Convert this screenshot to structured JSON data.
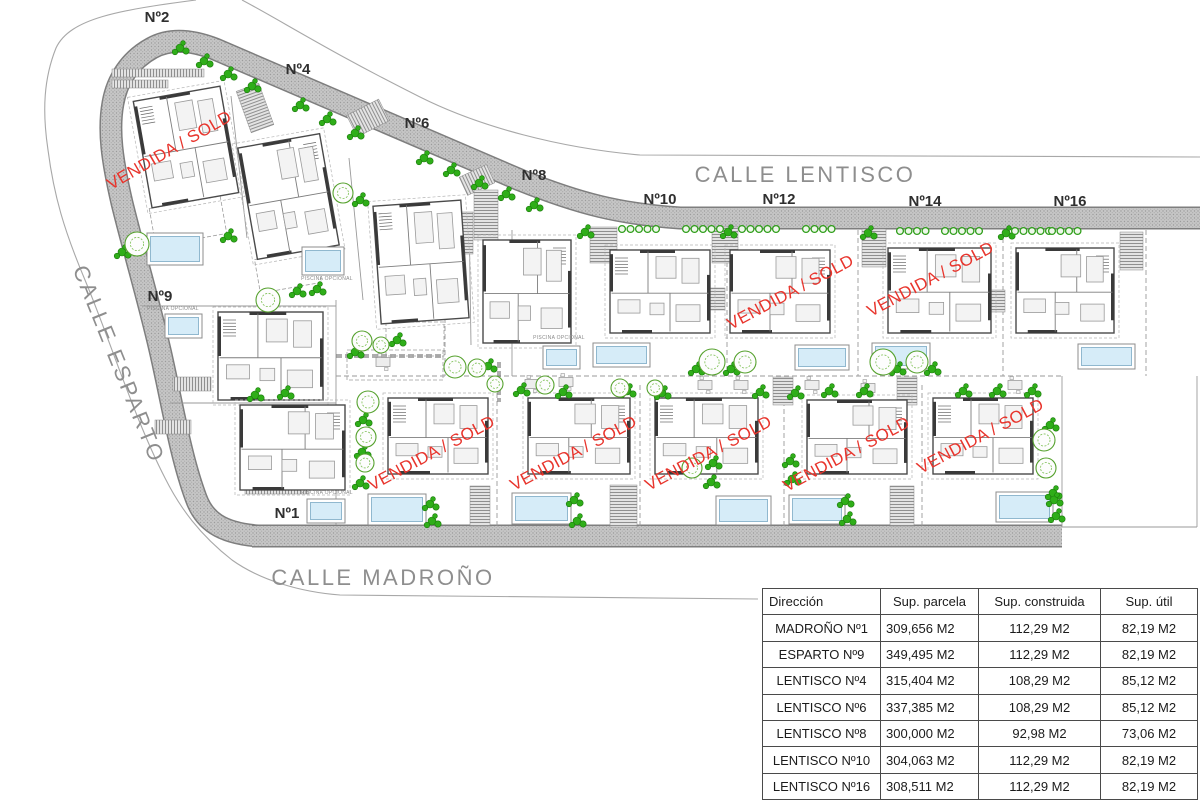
{
  "colors": {
    "road": "#c6c6c6",
    "road_edge": "#7e7e7e",
    "boundary": "#a8a8a8",
    "sold_red": "#e8342c",
    "street_text": "#8e8e8e",
    "lot_text": "#2f2f2f",
    "pool_water": "#d6ecf8",
    "pool_edge": "#90b8cf",
    "pool_frame": "#8c8c8c",
    "green": "#2fae19",
    "green_dark": "#1d7a0e",
    "tree_stroke": "#56a22e",
    "wall": "#4a4a4a",
    "line": "#9a9a9a"
  },
  "plan": {
    "streets": [
      {
        "id": "calle-lentisco",
        "label": "CALLE LENTISCO",
        "x": 805,
        "y": 182,
        "rot": 0
      },
      {
        "id": "calle-madrono",
        "label": "CALLE MADROÑO",
        "x": 383,
        "y": 585,
        "rot": 0
      },
      {
        "id": "calle-esparto",
        "label": "CALLE ESPARTO",
        "x": 112,
        "y": 367,
        "rot": 68
      }
    ],
    "lot_labels": [
      {
        "id": "lot-n2",
        "text": "Nº2",
        "x": 157,
        "y": 22
      },
      {
        "id": "lot-n4",
        "text": "Nº4",
        "x": 298,
        "y": 74
      },
      {
        "id": "lot-n6",
        "text": "Nº6",
        "x": 417,
        "y": 128
      },
      {
        "id": "lot-n8",
        "text": "Nº8",
        "x": 534,
        "y": 180
      },
      {
        "id": "lot-n10",
        "text": "Nº10",
        "x": 660,
        "y": 204
      },
      {
        "id": "lot-n12",
        "text": "Nº12",
        "x": 779,
        "y": 204
      },
      {
        "id": "lot-n14",
        "text": "Nº14",
        "x": 925,
        "y": 206
      },
      {
        "id": "lot-n16",
        "text": "Nº16",
        "x": 1070,
        "y": 206
      },
      {
        "id": "lot-n9",
        "text": "Nº9",
        "x": 160,
        "y": 301
      },
      {
        "id": "lot-n1",
        "text": "Nº1",
        "x": 287,
        "y": 518
      }
    ],
    "sold_label": "VENDIDA / SOLD",
    "sold_marks": [
      [
        172,
        155,
        -30
      ],
      [
        793,
        297,
        -28
      ],
      [
        933,
        284,
        -28
      ],
      [
        434,
        458,
        -28
      ],
      [
        576,
        458,
        -28
      ],
      [
        711,
        458,
        -28
      ],
      [
        849,
        459,
        -28
      ],
      [
        983,
        441,
        -28
      ]
    ],
    "pool_note": "PISCINA OPCIONAL",
    "pool_notes": [
      [
        173,
        310
      ],
      [
        327,
        280
      ],
      [
        327,
        494
      ],
      [
        559,
        339
      ]
    ],
    "roads": {
      "loop": "M 258,536 C 220,533 204,520 196,498 C 180,455 172,402 160,350 C 148,298 133,248 122,203 C 112,160 108,130 113,103 C 117,80 130,60 152,48 C 170,38 192,40 215,49 L 520,180 C 580,204 620,214 680,218 L 1200,218",
      "bottom": "M 252,536 L 1062,536",
      "width": 20
    },
    "boundaries": [
      "M 196,0 C 120,10 70,18 56,48 C 44,78 42,110 48,150 C 54,196 64,230 85,280 C 110,340 135,420 165,478 C 180,508 200,535 232,560 C 260,580 300,592 340,595 L 758,599",
      "M 242,0 C 280,20 330,52 420,97 C 480,127 560,148 640,155 L 1200,157"
    ],
    "plot_lines": [
      [
        512,
        230,
        512,
        376
      ],
      [
        1062,
        376,
        1062,
        527
      ],
      [
        1062,
        527,
        1197,
        527
      ],
      [
        1197,
        376,
        1197,
        527
      ],
      [
        231,
        96,
        247,
        238
      ],
      [
        349,
        158,
        363,
        300
      ],
      [
        469,
        212,
        471,
        345
      ],
      [
        142,
        306,
        336,
        306
      ],
      [
        170,
        403,
        336,
        403
      ],
      [
        336,
        300,
        336,
        525
      ]
    ],
    "plot_lines_dashed": [
      [
        727,
        230,
        727,
        376
      ],
      [
        858,
        230,
        858,
        376
      ],
      [
        1003,
        230,
        1003,
        376
      ],
      [
        1146,
        230,
        1146,
        376
      ],
      [
        336,
        376,
        1062,
        376
      ],
      [
        445,
        230,
        445,
        376
      ],
      [
        497,
        385,
        497,
        527
      ],
      [
        640,
        385,
        640,
        530
      ],
      [
        784,
        385,
        784,
        530
      ],
      [
        922,
        385,
        922,
        530
      ]
    ],
    "hedges": [
      [
        336,
        356,
        443,
        356
      ],
      [
        499,
        362,
        499,
        402
      ]
    ],
    "houses": [
      {
        "id": "house-n2",
        "x": 142,
        "y": 93,
        "w": 88,
        "h": 108,
        "rot": -10,
        "sold": true
      },
      {
        "id": "house-n4",
        "x": 247,
        "y": 140,
        "w": 83,
        "h": 113,
        "rot": -10,
        "sold": false
      },
      {
        "id": "house-n6",
        "x": 377,
        "y": 203,
        "w": 88,
        "h": 118,
        "rot": -4,
        "sold": false
      },
      {
        "id": "house-n8",
        "x": 483,
        "y": 240,
        "w": 88,
        "h": 103,
        "rot": 0,
        "sold": false
      },
      {
        "id": "house-n9",
        "x": 218,
        "y": 312,
        "w": 105,
        "h": 88,
        "rot": 0,
        "sold": false
      },
      {
        "id": "house-n1",
        "x": 240,
        "y": 405,
        "w": 105,
        "h": 85,
        "rot": 0,
        "sold": false
      },
      {
        "id": "house-n10",
        "x": 610,
        "y": 250,
        "w": 100,
        "h": 83,
        "rot": 0,
        "sold": false
      },
      {
        "id": "house-n12",
        "x": 730,
        "y": 250,
        "w": 100,
        "h": 83,
        "rot": 0,
        "sold": true
      },
      {
        "id": "house-n14",
        "x": 888,
        "y": 248,
        "w": 103,
        "h": 85,
        "rot": 0,
        "sold": true
      },
      {
        "id": "house-n16",
        "x": 1016,
        "y": 248,
        "w": 98,
        "h": 85,
        "rot": 0,
        "sold": false
      },
      {
        "id": "house-madrono-row-1",
        "x": 388,
        "y": 398,
        "w": 100,
        "h": 76,
        "rot": 0,
        "sold": true
      },
      {
        "id": "house-madrono-row-2",
        "x": 528,
        "y": 398,
        "w": 102,
        "h": 76,
        "rot": 0,
        "sold": true
      },
      {
        "id": "house-madrono-row-3",
        "x": 655,
        "y": 398,
        "w": 103,
        "h": 76,
        "rot": 0,
        "sold": true
      },
      {
        "id": "house-madrono-row-4",
        "x": 807,
        "y": 400,
        "w": 100,
        "h": 74,
        "rot": 0,
        "sold": true
      },
      {
        "id": "house-madrono-row-5",
        "x": 933,
        "y": 398,
        "w": 100,
        "h": 76,
        "rot": 0,
        "sold": true
      }
    ],
    "terraces": [
      [
        152,
        202,
        72,
        38,
        -10
      ],
      [
        257,
        254,
        62,
        34,
        -10
      ],
      [
        386,
        322,
        58,
        34,
        0
      ],
      [
        347,
        350,
        96,
        30,
        0
      ]
    ],
    "pools": [
      {
        "id": "pool-n2",
        "r": [
          147,
          233,
          56,
          32
        ]
      },
      {
        "id": "pool-n4",
        "r": [
          302,
          247,
          42,
          28
        ]
      },
      {
        "id": "pool-n9",
        "r": [
          165,
          314,
          37,
          24
        ]
      },
      {
        "id": "pool-n1",
        "r": [
          307,
          499,
          38,
          24
        ]
      },
      {
        "id": "pool-n6",
        "r": [
          543,
          346,
          37,
          23
        ]
      },
      {
        "id": "pool-n8",
        "r": [
          593,
          343,
          57,
          24
        ]
      },
      {
        "id": "pool-n12",
        "r": [
          795,
          345,
          54,
          25
        ]
      },
      {
        "id": "pool-n14",
        "r": [
          872,
          343,
          58,
          26
        ]
      },
      {
        "id": "pool-n16",
        "r": [
          1078,
          344,
          57,
          25
        ]
      },
      {
        "id": "pool-m1",
        "r": [
          368,
          494,
          58,
          31
        ]
      },
      {
        "id": "pool-m2",
        "r": [
          512,
          493,
          59,
          31
        ]
      },
      {
        "id": "pool-m3",
        "r": [
          716,
          496,
          55,
          29
        ]
      },
      {
        "id": "pool-m4",
        "r": [
          789,
          495,
          56,
          29
        ]
      },
      {
        "id": "pool-m5",
        "r": [
          996,
          492,
          57,
          30
        ]
      }
    ],
    "driveways": [
      [
        112,
        69,
        92,
        8,
        0
      ],
      [
        112,
        80,
        56,
        8,
        0
      ],
      [
        243,
        86,
        24,
        44,
        -20
      ],
      [
        350,
        106,
        36,
        24,
        -27
      ],
      [
        462,
        170,
        30,
        20,
        -25
      ],
      [
        447,
        212,
        26,
        42,
        0
      ],
      [
        474,
        190,
        24,
        50,
        0
      ],
      [
        590,
        227,
        27,
        36,
        0
      ],
      [
        712,
        227,
        26,
        36,
        0
      ],
      [
        862,
        229,
        24,
        38,
        0
      ],
      [
        1120,
        232,
        23,
        38,
        0
      ],
      [
        708,
        288,
        17,
        22,
        0
      ],
      [
        988,
        290,
        17,
        22,
        0
      ],
      [
        470,
        486,
        20,
        40,
        0
      ],
      [
        610,
        485,
        27,
        42,
        0
      ],
      [
        890,
        486,
        24,
        40,
        0
      ],
      [
        773,
        377,
        20,
        28,
        0
      ],
      [
        897,
        377,
        20,
        28,
        0
      ],
      [
        173,
        377,
        38,
        14,
        0
      ],
      [
        155,
        420,
        36,
        14,
        0
      ],
      [
        245,
        485,
        64,
        9,
        0
      ]
    ],
    "ring_rows": [
      [
        622,
        229,
        5
      ],
      [
        686,
        229,
        5
      ],
      [
        742,
        229,
        5
      ],
      [
        806,
        229,
        4
      ],
      [
        900,
        231,
        4
      ],
      [
        945,
        231,
        5
      ],
      [
        1015,
        231,
        5
      ],
      [
        1052,
        231,
        4
      ]
    ],
    "clusters": [
      [
        180,
        48
      ],
      [
        204,
        61
      ],
      [
        228,
        74
      ],
      [
        252,
        86
      ],
      [
        300,
        105
      ],
      [
        327,
        119
      ],
      [
        355,
        133
      ],
      [
        424,
        158
      ],
      [
        451,
        170
      ],
      [
        479,
        183
      ],
      [
        506,
        194
      ],
      [
        534,
        205
      ],
      [
        585,
        232
      ],
      [
        728,
        232
      ],
      [
        868,
        233
      ],
      [
        1006,
        233
      ],
      [
        122,
        252
      ],
      [
        228,
        236
      ],
      [
        297,
        291
      ],
      [
        317,
        289
      ],
      [
        360,
        200
      ],
      [
        355,
        352
      ],
      [
        397,
        340
      ],
      [
        488,
        366
      ],
      [
        521,
        390
      ],
      [
        563,
        392
      ],
      [
        627,
        391
      ],
      [
        662,
        393
      ],
      [
        696,
        369
      ],
      [
        731,
        369
      ],
      [
        760,
        392
      ],
      [
        795,
        393
      ],
      [
        829,
        391
      ],
      [
        864,
        391
      ],
      [
        897,
        369
      ],
      [
        932,
        369
      ],
      [
        963,
        391
      ],
      [
        997,
        391
      ],
      [
        1032,
        391
      ],
      [
        1050,
        425
      ],
      [
        1053,
        493
      ],
      [
        430,
        504
      ],
      [
        432,
        521
      ],
      [
        574,
        500
      ],
      [
        577,
        521
      ],
      [
        713,
        463
      ],
      [
        711,
        482
      ],
      [
        790,
        461
      ],
      [
        792,
        479
      ],
      [
        845,
        501
      ],
      [
        847,
        519
      ],
      [
        1054,
        500
      ],
      [
        1056,
        516
      ],
      [
        363,
        420
      ],
      [
        362,
        452
      ],
      [
        360,
        483
      ],
      [
        255,
        395
      ],
      [
        285,
        393
      ]
    ],
    "trees": [
      [
        137,
        244,
        12
      ],
      [
        268,
        300,
        12
      ],
      [
        343,
        193,
        10
      ],
      [
        362,
        341,
        10
      ],
      [
        381,
        345,
        8
      ],
      [
        455,
        367,
        11
      ],
      [
        477,
        368,
        9
      ],
      [
        495,
        384,
        8
      ],
      [
        545,
        385,
        9
      ],
      [
        620,
        388,
        9
      ],
      [
        655,
        388,
        8
      ],
      [
        712,
        362,
        13
      ],
      [
        745,
        362,
        11
      ],
      [
        883,
        362,
        13
      ],
      [
        917,
        362,
        11
      ],
      [
        692,
        468,
        10
      ],
      [
        1044,
        440,
        11
      ],
      [
        1046,
        468,
        10
      ],
      [
        368,
        402,
        11
      ],
      [
        366,
        437,
        10
      ],
      [
        365,
        463,
        9
      ]
    ],
    "furniture_spots": [
      [
        383,
        362
      ],
      [
        532,
        384
      ],
      [
        566,
        382
      ],
      [
        705,
        385
      ],
      [
        741,
        385
      ],
      [
        812,
        385
      ],
      [
        868,
        388
      ],
      [
        1015,
        385
      ]
    ]
  },
  "table": {
    "headers": [
      "Dirección",
      "Sup. parcela",
      "Sup. construida",
      "Sup. útil"
    ],
    "col_widths": [
      118,
      98,
      122,
      97
    ],
    "rows": [
      [
        "MADROÑO Nº1",
        "309,656 M2",
        "112,29 M2",
        "82,19 M2"
      ],
      [
        "ESPARTO Nº9",
        "349,495 M2",
        "112,29 M2",
        "82,19 M2"
      ],
      [
        "LENTISCO Nº4",
        "315,404 M2",
        "108,29 M2",
        "85,12 M2"
      ],
      [
        "LENTISCO Nº6",
        "337,385 M2",
        "108,29 M2",
        "85,12 M2"
      ],
      [
        "LENTISCO Nº8",
        "300,000 M2",
        "92,98 M2",
        "73,06 M2"
      ],
      [
        "LENTISCO Nº10",
        "304,063 M2",
        "112,29 M2",
        "82,19 M2"
      ],
      [
        "LENTISCO Nº16",
        "308,511 M2",
        "112,29 M2",
        "82,19 M2"
      ]
    ]
  }
}
